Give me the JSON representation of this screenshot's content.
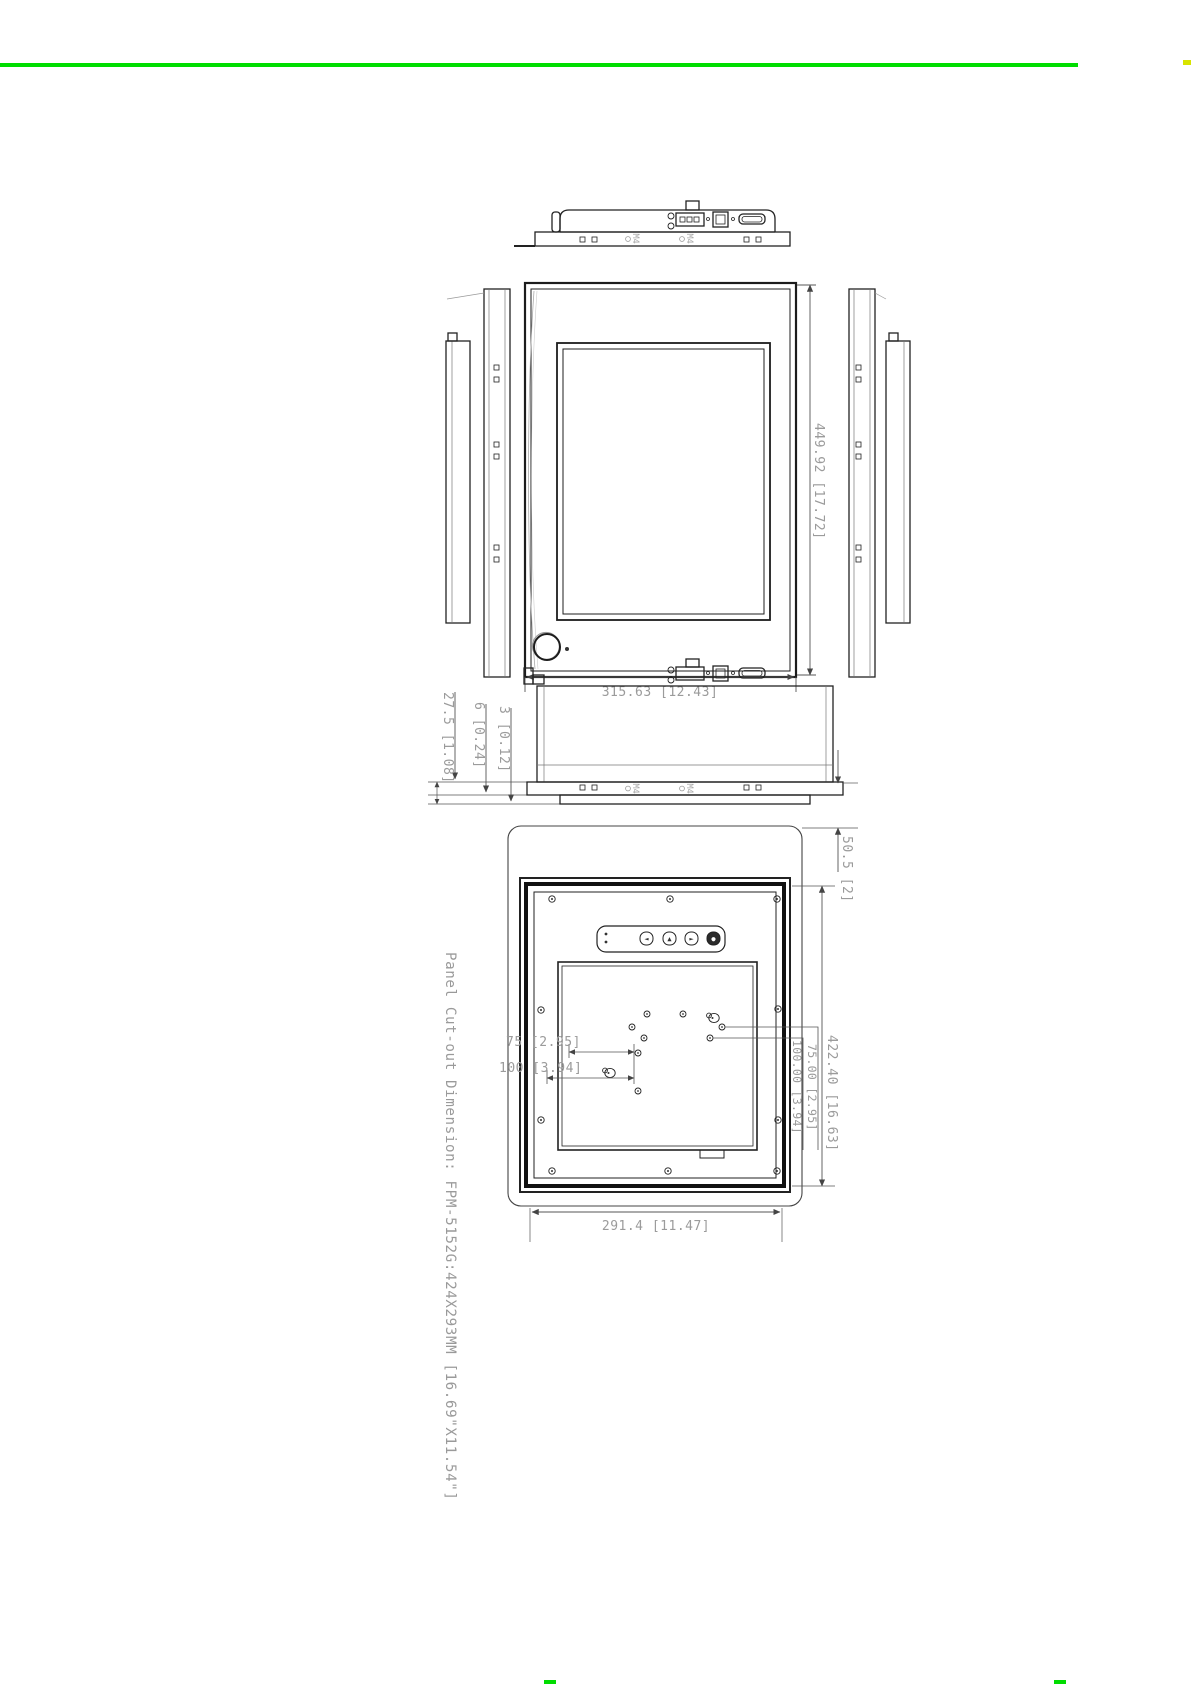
{
  "page": {
    "background": "#ffffff",
    "top_rule_color": "#00dd00",
    "edge_mark_color": "#d8e400"
  },
  "drawing": {
    "caption": "Panel Cut-out Dimension: FPM-5152G:424X293MM [16.69\"X11.54\"]",
    "dimensions": {
      "front_width": "315.63 [12.43]",
      "front_height": "449.92 [17.72]",
      "depth_total": "27.5 [1.08]",
      "bezel_thickness": "6 [0.24]",
      "glass_protrusion": "3 [0.12]",
      "mount_depth": "50.5 [2]",
      "cutout_height": "422.40 [16.63]",
      "vesa_vertical_100": "100.00 [3.94]",
      "vesa_vertical_75": "75.00 [2.95]",
      "vesa_horizontal_75": "75 [2.95]",
      "vesa_horizontal_100": "100 [3.94]",
      "cutout_width": "291.4 [11.47]"
    },
    "labels": {
      "screw": "M4"
    },
    "osd_buttons": [
      "◄",
      "▲",
      "►",
      "●"
    ]
  }
}
